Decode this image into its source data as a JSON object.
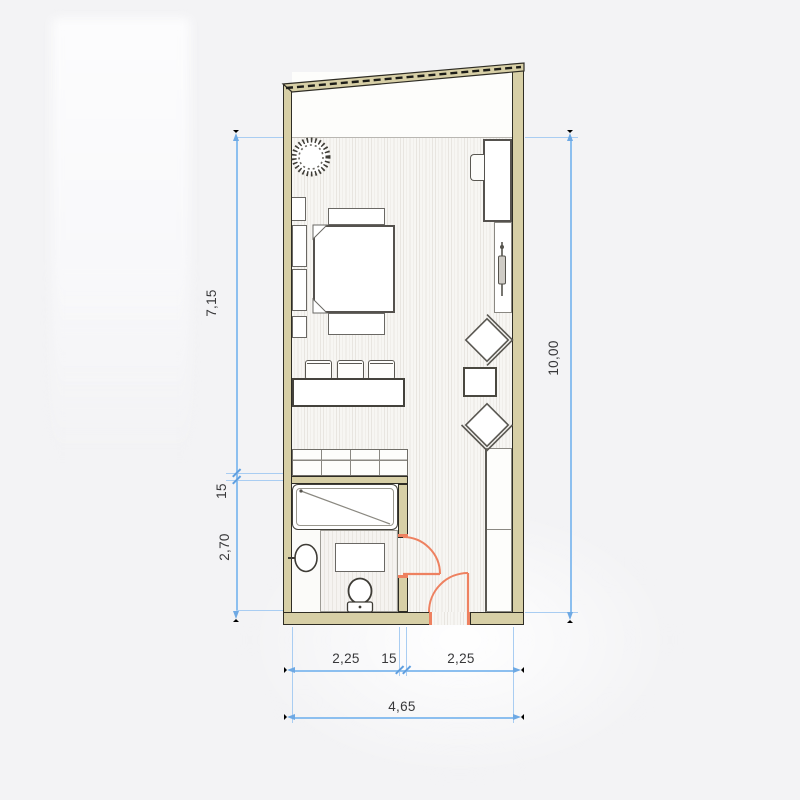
{
  "drawing": {
    "kind": "studio-apartment-floor-plan",
    "colors": {
      "wall": "#d7cfa6",
      "wall_outline": "#2e2c24",
      "door": "#ee8160",
      "dimension_line": "#8cbfef",
      "dimension_text": "#38383a",
      "floor_hatch": "#e8e5e0",
      "furniture_outline": "#5a5852"
    },
    "dimensions": {
      "left": [
        {
          "label": "7,15"
        },
        {
          "label": "15"
        },
        {
          "label": "2,70"
        }
      ],
      "right": [
        {
          "label": "10,00"
        }
      ],
      "bottom_segments": [
        {
          "label": "2,25"
        },
        {
          "label": "15"
        },
        {
          "label": "2,25"
        }
      ],
      "bottom_total": {
        "label": "4,65"
      }
    },
    "furniture_icons": [
      "plant-icon",
      "desk",
      "desk-chair-icon",
      "floor-lamp-icon",
      "bed",
      "nightstand",
      "bar-stool",
      "counter",
      "dresser",
      "wardrobe",
      "lounge-chair-icon",
      "side-table",
      "bathtub-icon",
      "sink-icon",
      "vanity",
      "toilet-icon",
      "bathroom-door",
      "entry-door"
    ]
  }
}
